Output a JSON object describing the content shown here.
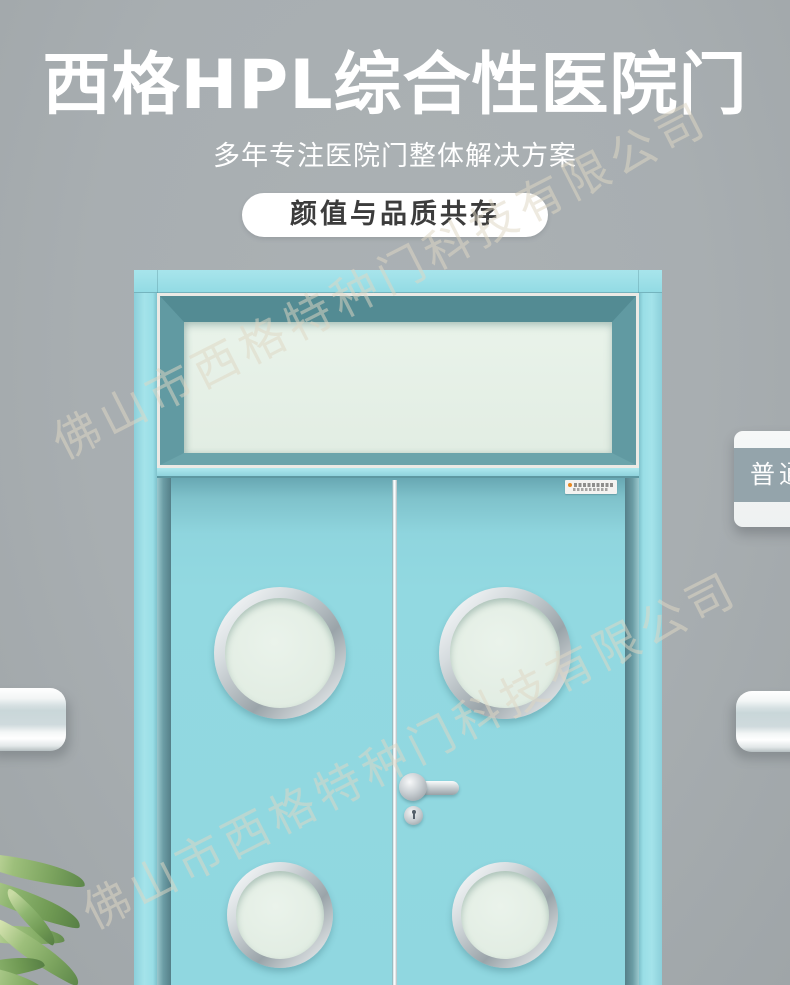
{
  "banner": {
    "title": "西格HPL综合性医院门",
    "subtitle": "多年专注医院门整体解决方案",
    "badge": "颜值与品质共存"
  },
  "watermark": {
    "company_name": "佛山市西格特种门科技有限公司"
  },
  "room_sign": {
    "label": "普通"
  },
  "colors": {
    "wall_gray": "#a8aeb1",
    "headline_text": "#ffffff",
    "badge_bg": "#ffffff",
    "badge_text": "#3c3c3c",
    "door_frame_cyan": "#9adee6",
    "door_leaf_cyan": "#90d7e0",
    "transom_frame_teal": "#5d98a0",
    "frosted_glass_mint": "#e6f0e8",
    "hardware_silver": "#c6cdd1",
    "sign_band_gray": "#94a4ab",
    "rail_band": "#cfdadd",
    "plant_green": "#8fb671",
    "brand_dot_orange": "#e8871f",
    "watermark_tint": "rgba(223,214,195,0.52)"
  }
}
